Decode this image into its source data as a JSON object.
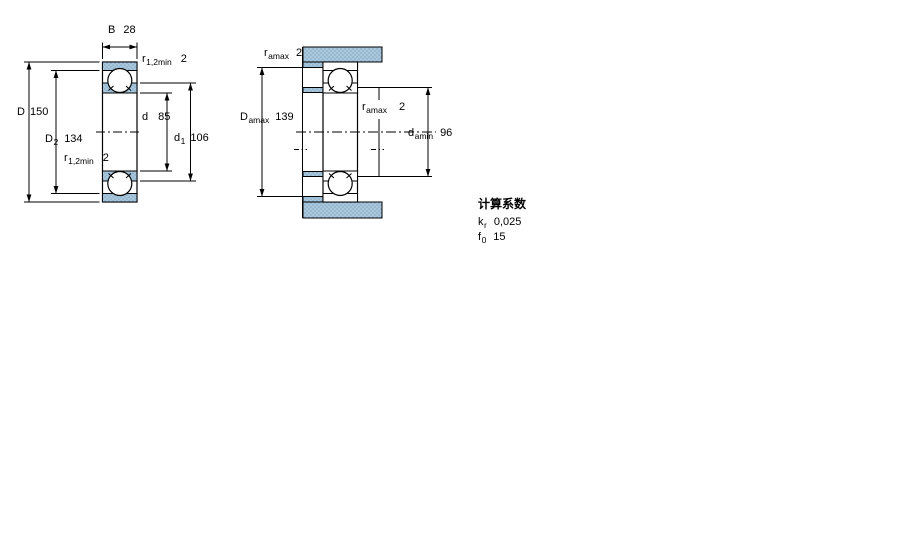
{
  "drawing": {
    "fill_blue": "#aac7dc",
    "dot_blue": "#7fa8c4",
    "line_color": "#000000"
  },
  "left_diagram": {
    "labels": {
      "width": {
        "sym": "B",
        "sub": "",
        "val": "28"
      },
      "fillet_top": {
        "sym": "r",
        "sub": "1,2min",
        "val": "2"
      },
      "outer_dia": {
        "sym": "D",
        "sub": "",
        "val": "150"
      },
      "recess_dia": {
        "sym": "D",
        "sub": "2",
        "val": "134"
      },
      "bore_dia": {
        "sym": "d",
        "sub": "",
        "val": "85"
      },
      "shoulder_dia": {
        "sym": "d",
        "sub": "1",
        "val": "106"
      },
      "fillet_bottom": {
        "sym": "r",
        "sub": "1,2min",
        "val": "2"
      }
    }
  },
  "right_diagram": {
    "labels": {
      "housing_fillet": {
        "sym": "r",
        "sub": "amax",
        "val": "2"
      },
      "housing_shoulder": {
        "sym": "D",
        "sub": "amax",
        "val": "139"
      },
      "shaft_fillet": {
        "sym": "r",
        "sub": "amax",
        "val": "2"
      },
      "shaft_shoulder": {
        "sym": "d",
        "sub": "amin",
        "val": "96"
      }
    }
  },
  "calculation_factors": {
    "title": "计算系数",
    "rows": [
      {
        "sym": "k",
        "sub": "r",
        "val": "0,025"
      },
      {
        "sym": "f",
        "sub": "0",
        "val": "15"
      }
    ]
  }
}
